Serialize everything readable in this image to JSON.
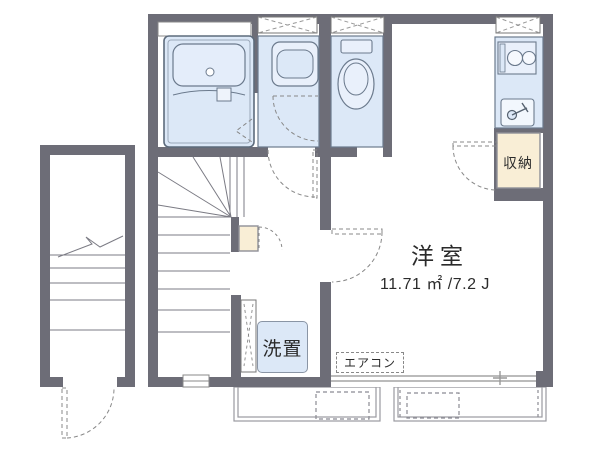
{
  "labels": {
    "room": "洋室",
    "room_area": "11.71 ㎡ /7.2 J",
    "aircon": "エアコン",
    "washer": "洗置",
    "closet": "収納"
  },
  "colors": {
    "wall": "#6d6d77",
    "fixture_fill": "#dce8f7",
    "fixture_fill_light": "#e9f0fb",
    "fixture_stroke": "#6b7a8d",
    "closet_fill": "#f9eed6",
    "dash_line": "#888888",
    "balcony_stroke": "#9a9aa0",
    "text": "#2b2b2b"
  },
  "fixtures": [
    "bathtub",
    "washbasin",
    "toilet",
    "kitchen-stove",
    "kitchen-sink",
    "closet",
    "under-stair-storage",
    "interior-staircase",
    "exterior-staircase",
    "balcony-left",
    "balcony-right",
    "washing-machine-slot",
    "sliding-window",
    "entry-door"
  ]
}
